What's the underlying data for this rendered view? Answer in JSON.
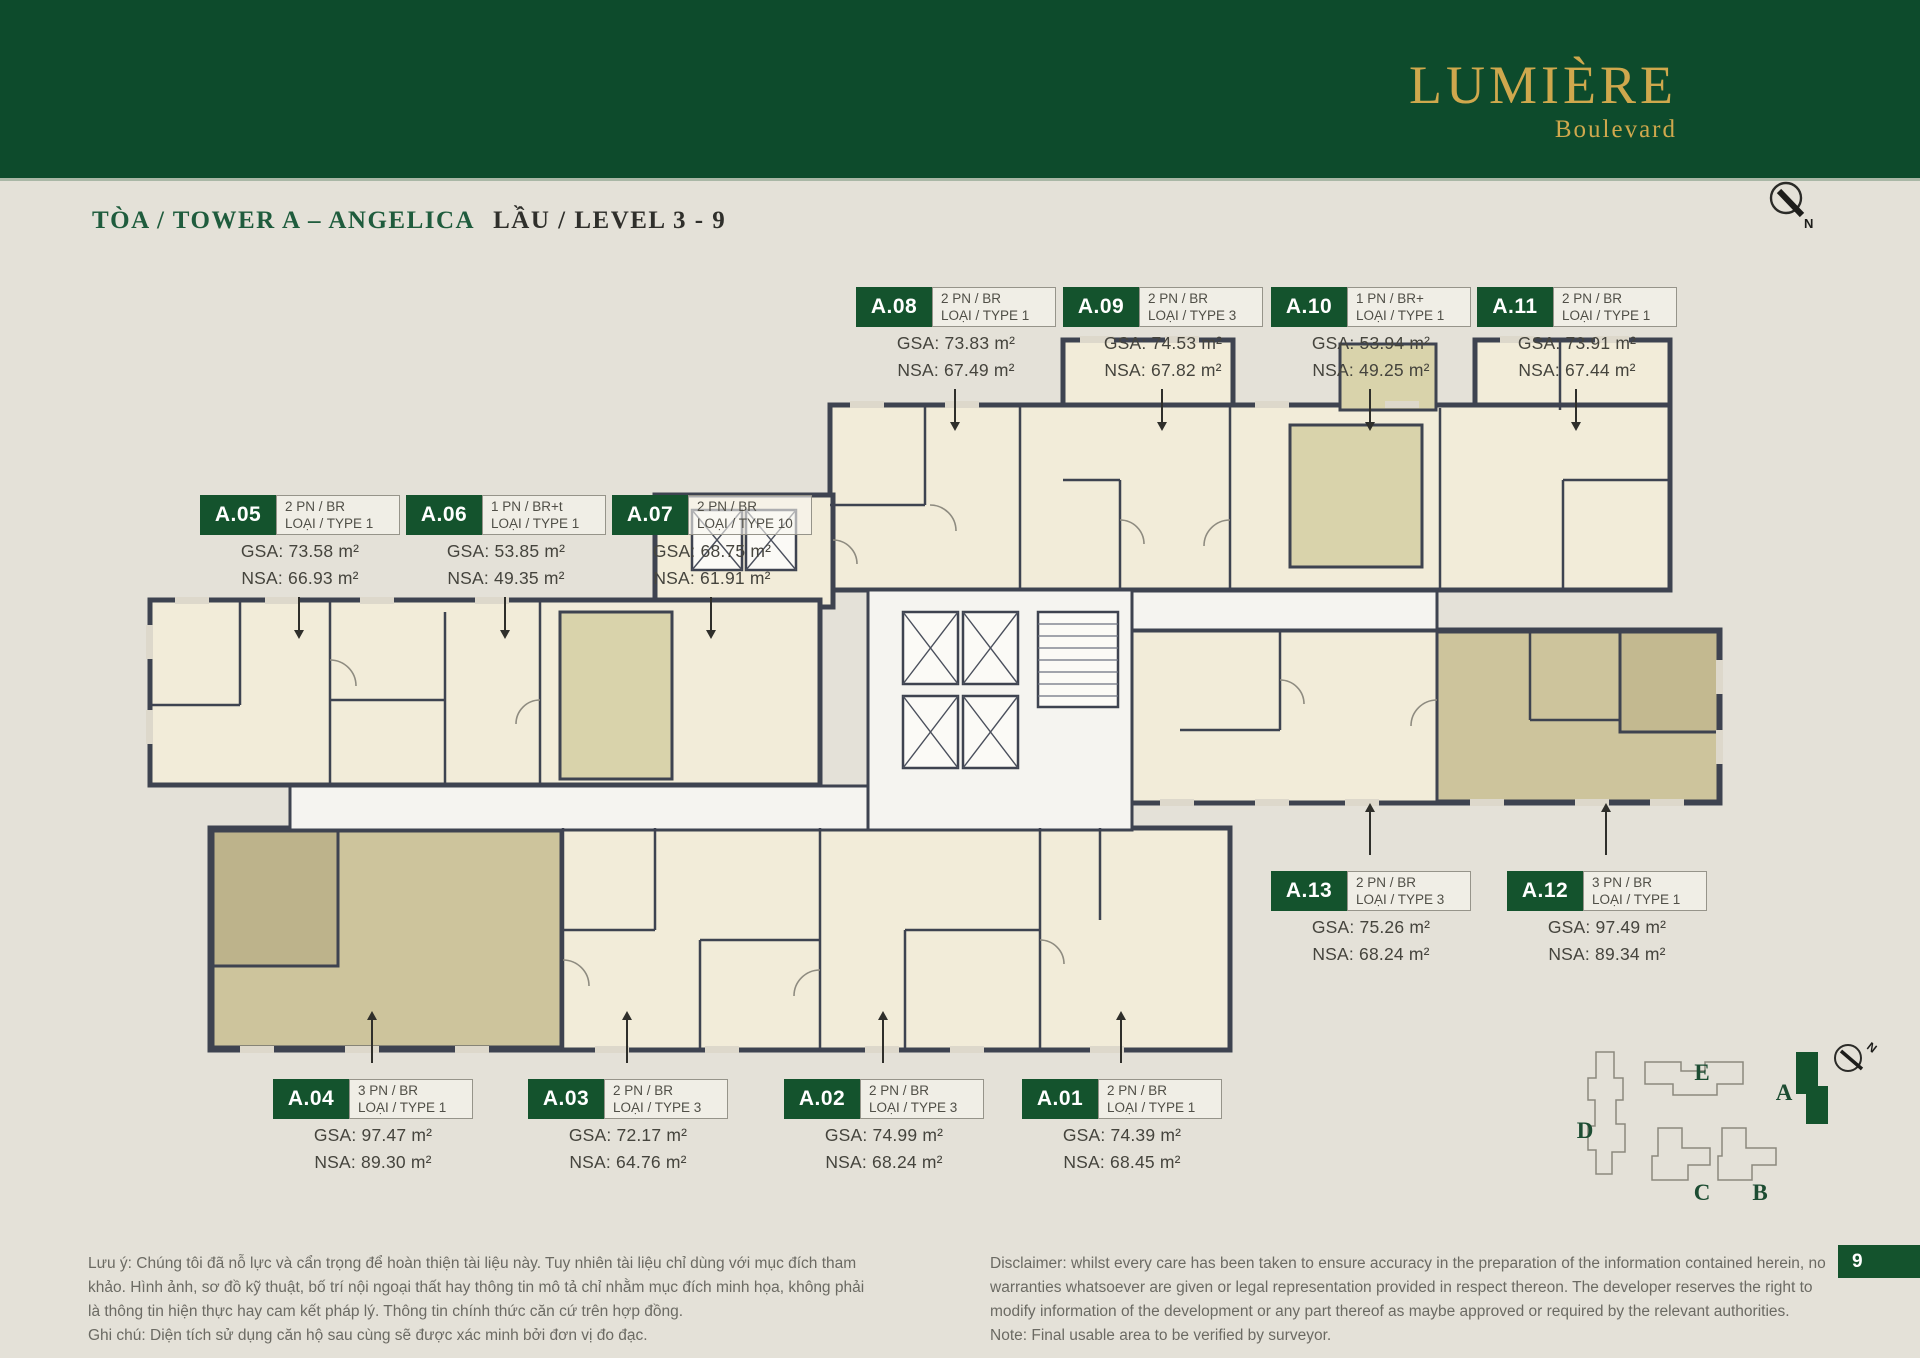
{
  "header": {
    "logo_title": "LUMIÈRE",
    "logo_subtitle": "Boulevard"
  },
  "title": {
    "tower": "TÒA / TOWER A – ANGELICA",
    "level": "LẦU / LEVEL 3 - 9"
  },
  "compass": {
    "north_label": "N"
  },
  "units": [
    {
      "id": "A.08",
      "bedrooms": "2 PN / BR",
      "type": "LOẠI / TYPE 1",
      "gsa": "GSA: 73.83 m²",
      "nsa": "NSA: 67.49 m²"
    },
    {
      "id": "A.09",
      "bedrooms": "2 PN / BR",
      "type": "LOẠI / TYPE 3",
      "gsa": "GSA: 74.53 m²",
      "nsa": "NSA: 67.82 m²"
    },
    {
      "id": "A.10",
      "bedrooms": "1 PN / BR+",
      "type": "LOẠI / TYPE 1",
      "gsa": "GSA: 53.94 m²",
      "nsa": "NSA: 49.25 m²"
    },
    {
      "id": "A.11",
      "bedrooms": "2 PN / BR",
      "type": "LOẠI / TYPE 1",
      "gsa": "GSA: 73.91 m²",
      "nsa": "NSA: 67.44 m²"
    },
    {
      "id": "A.05",
      "bedrooms": "2 PN / BR",
      "type": "LOẠI / TYPE 1",
      "gsa": "GSA: 73.58 m²",
      "nsa": "NSA: 66.93 m²"
    },
    {
      "id": "A.06",
      "bedrooms": "1 PN / BR+t",
      "type": "LOẠI / TYPE 1",
      "gsa": "GSA: 53.85 m²",
      "nsa": "NSA: 49.35 m²"
    },
    {
      "id": "A.07",
      "bedrooms": "2 PN / BR",
      "type": "LOẠI / TYPE 10",
      "gsa": "GSA: 68.75 m²",
      "nsa": "NSA: 61.91 m²"
    },
    {
      "id": "A.13",
      "bedrooms": "2 PN / BR",
      "type": "LOẠI / TYPE 3",
      "gsa": "GSA: 75.26 m²",
      "nsa": "NSA: 68.24 m²"
    },
    {
      "id": "A.12",
      "bedrooms": "3 PN / BR",
      "type": "LOẠI / TYPE 1",
      "gsa": "GSA: 97.49 m²",
      "nsa": "NSA: 89.34 m²"
    },
    {
      "id": "A.04",
      "bedrooms": "3 PN / BR",
      "type": "LOẠI / TYPE 1",
      "gsa": "GSA: 97.47 m²",
      "nsa": "NSA: 89.30 m²"
    },
    {
      "id": "A.03",
      "bedrooms": "2 PN / BR",
      "type": "LOẠI / TYPE 3",
      "gsa": "GSA: 72.17 m²",
      "nsa": "NSA: 64.76 m²"
    },
    {
      "id": "A.02",
      "bedrooms": "2 PN / BR",
      "type": "LOẠI / TYPE 3",
      "gsa": "GSA: 74.99 m²",
      "nsa": "NSA: 68.24 m²"
    },
    {
      "id": "A.01",
      "bedrooms": "2 PN / BR",
      "type": "LOẠI / TYPE 1",
      "gsa": "GSA: 74.39 m²",
      "nsa": "NSA: 68.45 m²"
    }
  ],
  "keyplan": {
    "towers": [
      "E",
      "A",
      "D",
      "C",
      "B"
    ],
    "north_label": "N"
  },
  "footer": {
    "vi_disclaimer": "Lưu ý: Chúng tôi đã nỗ lực và cẩn trọng để hoàn thiện tài liệu này. Tuy nhiên tài liệu chỉ dùng với mục đích tham khảo. Hình ảnh, sơ đồ kỹ thuật, bố trí nội ngoại thất hay thông tin mô tả chỉ nhằm mục đích minh họa, không phải là thông tin hiện thực hay cam kết pháp lý. Thông tin chính thức căn cứ trên hợp đồng.",
    "vi_note": "Ghi chú: Diện tích sử dụng căn hộ sau cùng sẽ được xác minh bởi đơn vị đo đạc.",
    "en_disclaimer": "Disclaimer: whilst every care has been taken to ensure accuracy in the preparation of the information contained herein, no warranties whatsoever are given or legal representation provided in respect thereon. The developer reserves the right to modify information of the development or any part thereof as maybe approved or required by the relevant authorities.",
    "en_note": "Note: Final usable area to be verified by surveyor.",
    "page_number": "9"
  },
  "colors": {
    "brand_green": "#0d4b2c",
    "chip_green": "#14532d",
    "gold": "#cfa84d",
    "wall": "#3e4350"
  }
}
